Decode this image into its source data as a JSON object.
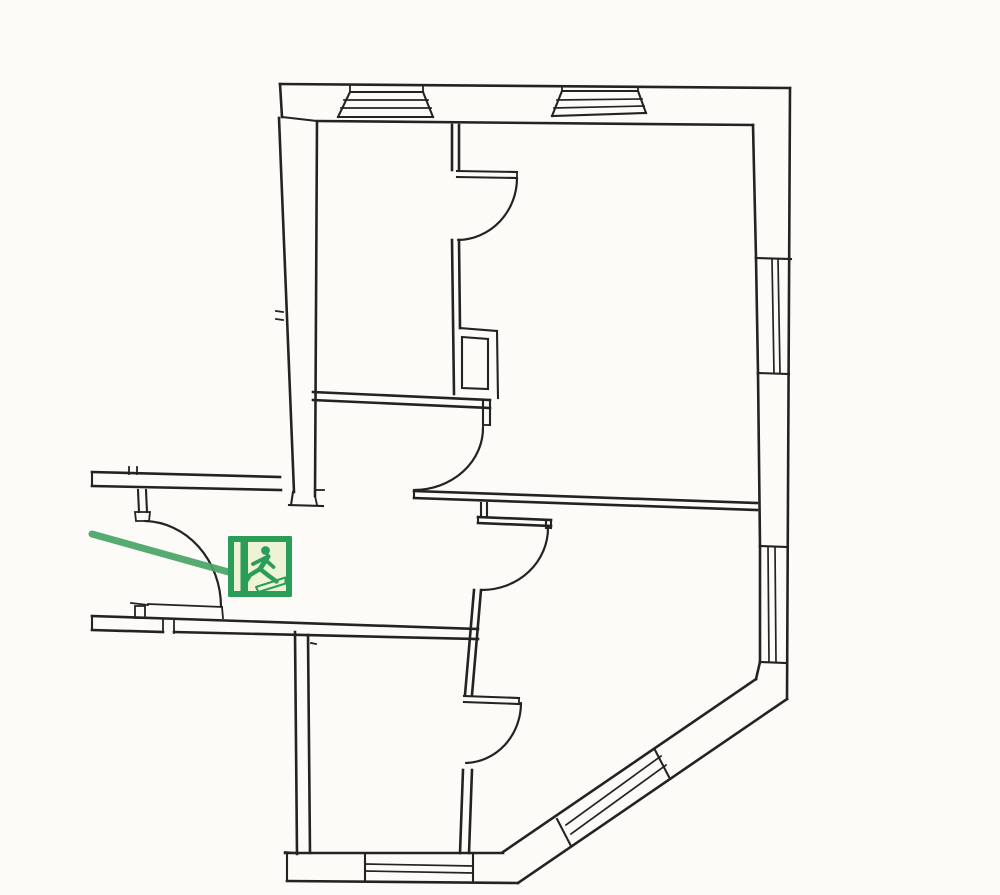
{
  "meta": {
    "title": "Evacuation floor plan (scanned line drawing)",
    "drawing_type": "architectural-floor-plan",
    "contains_text": false
  },
  "palette": {
    "paper": "#fcfbf8",
    "ink": "#232323",
    "route": "#47a465",
    "sign-green": "#2a9e58",
    "sign-panel": "#eef3d6"
  },
  "plan": {
    "rooms_visible": 6,
    "door_swing_arcs": 5,
    "window_symbols": [
      {
        "location": "right-wall-upper"
      },
      {
        "location": "right-wall-lower"
      },
      {
        "location": "diagonal-chamfer-wall"
      },
      {
        "location": "bottom-wall"
      }
    ],
    "heater_symbols": [
      {
        "location": "top-wall-left"
      },
      {
        "location": "top-wall-right"
      }
    ],
    "corridor": {
      "open_ended": "left-edge"
    }
  },
  "escape_route": {
    "color": "#47a465",
    "from": "left-image-edge",
    "to": "emergency-exit-sign"
  },
  "exit_sign": {
    "symbol": "running-man-toward-left-door",
    "background": "#2a9e58",
    "panel": "#eef3d6"
  }
}
